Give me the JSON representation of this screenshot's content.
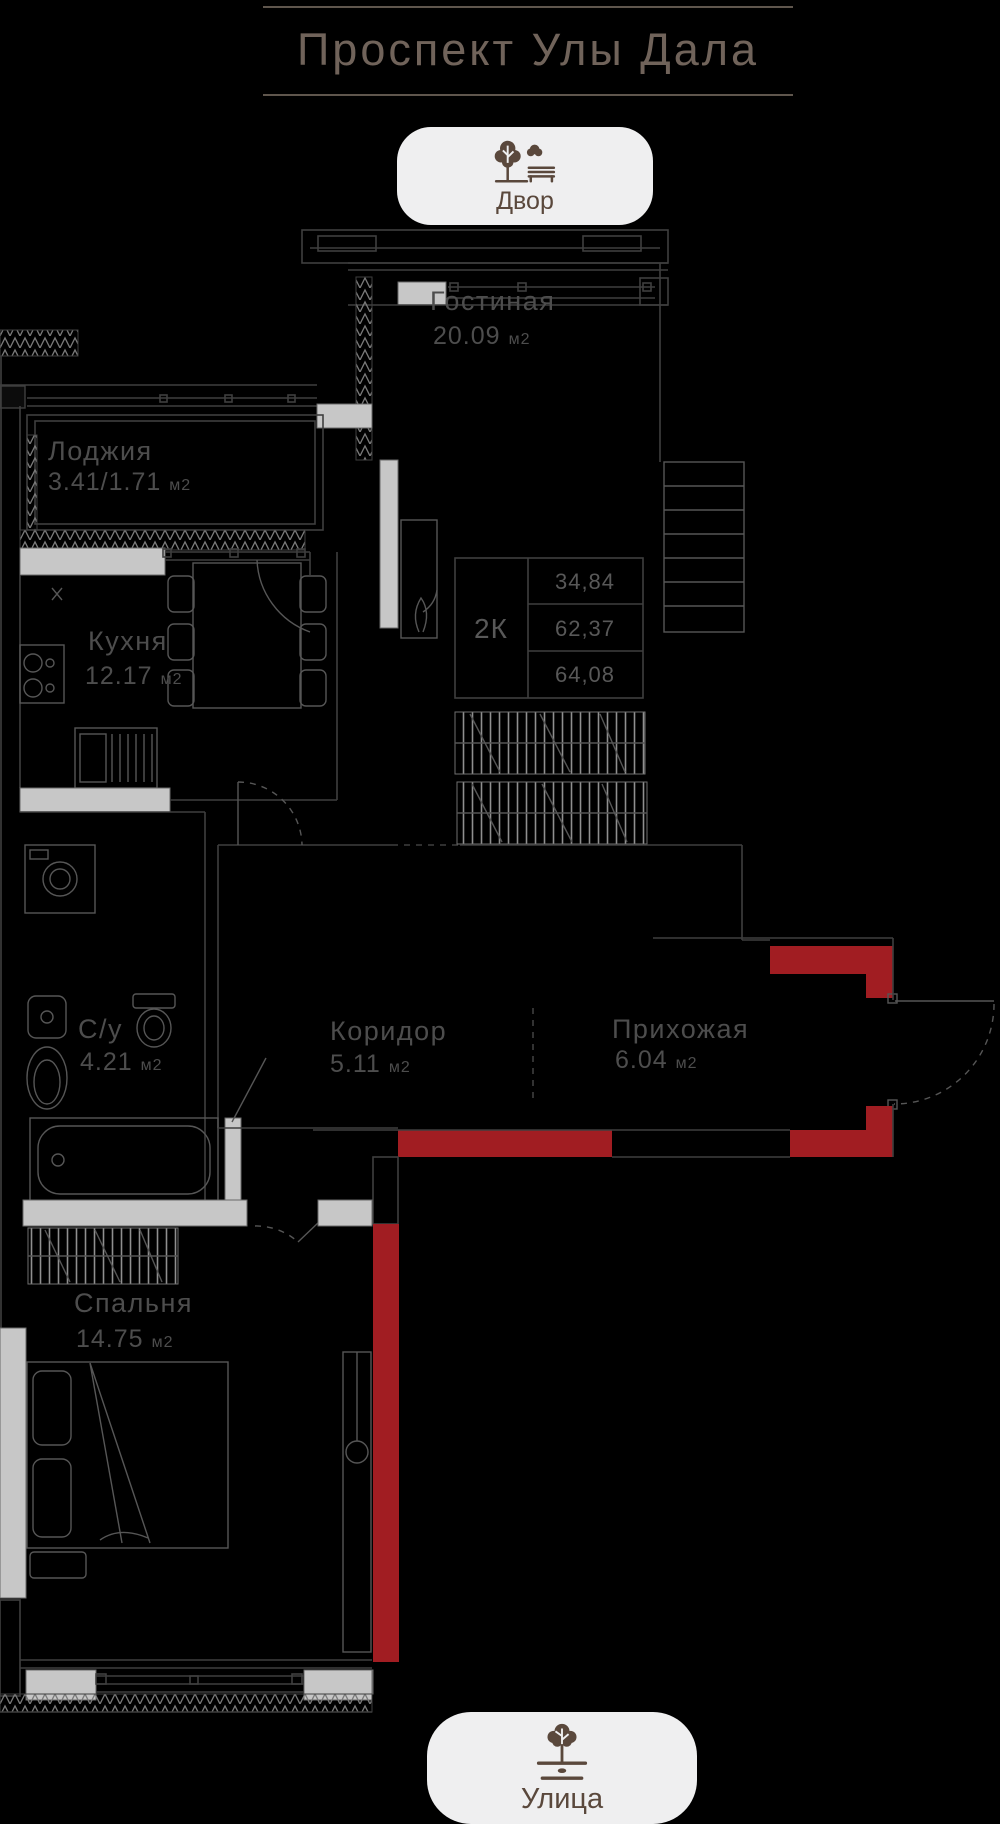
{
  "header": {
    "title": "Проспект Улы Дала"
  },
  "markers": {
    "top": {
      "label": "Двор",
      "icon": "park-tree-bench-icon"
    },
    "bottom": {
      "label": "Улица",
      "icon": "street-tree-icon"
    }
  },
  "unit_suffix": "м2",
  "rooms": {
    "living": {
      "name": "Гостиная",
      "area": "20.09"
    },
    "loggia": {
      "name": "Лоджия",
      "area": "3.41/1.71"
    },
    "kitchen": {
      "name": "Кухня",
      "area": "12.17"
    },
    "bath": {
      "name": "С/у",
      "area": "4.21"
    },
    "corridor": {
      "name": "Коридор",
      "area": "5.11"
    },
    "hall": {
      "name": "Прихожая",
      "area": "6.04"
    },
    "bedroom": {
      "name": "Спальня",
      "area": "14.75"
    }
  },
  "info_table": {
    "type": "2К",
    "rows": [
      "34,84",
      "62,37",
      "64,08"
    ]
  },
  "colors": {
    "background": "#000000",
    "accent_red": "#a11d22",
    "wall_gray": "#c7c7c7",
    "badge_bg": "#efeff0",
    "badge_fg": "#5a483c",
    "title": "#70635a",
    "label": "#4d4d4d"
  }
}
